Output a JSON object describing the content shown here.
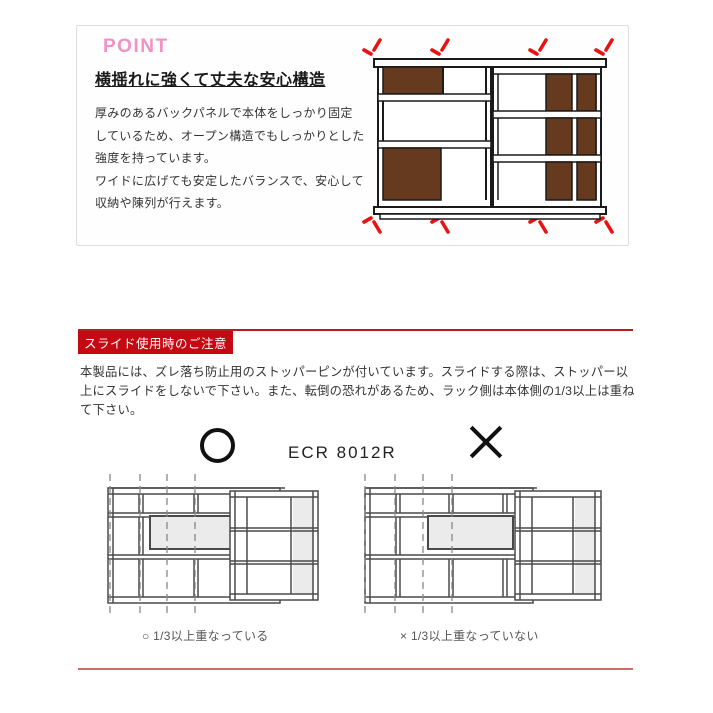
{
  "point_section": {
    "label": "POINT",
    "heading": "横揺れに強くて丈夫な安心構造",
    "body_lines": [
      "厚みのあるバックパネルで本体をしっかり固定",
      "しているため、オープン構造でもしっかりとした",
      "強度を持っています。",
      "ワイドに広げても安定したバランスで、安心して",
      "収納や陳列が行えます。"
    ]
  },
  "caution_section": {
    "title": "スライド使用時のご注意",
    "paragraph": "本製品には、ズレ落ち防止用のストッパーピンが付いています。スライドする際は、ストッパー以上にスライドをしないで下さい。また、転倒の恐れがあるため、ラック側は本体側の1/3以上は重ねて下さい。",
    "model": "ECR 8012R",
    "ok_symbol": "○",
    "ng_symbol": "×",
    "ok_caption": "○ 1/3以上重なっている",
    "ng_caption": "× 1/3以上重なっていない"
  },
  "colors": {
    "accent_pink": "#f291c5",
    "caution_red": "#c60812",
    "rule_red_top": "#b81c22",
    "rule_red_bottom": "#cf6b6b",
    "wood_brown": "#653a1f",
    "shake_mark_red": "#e81313",
    "diagram_gray": "#ebebeb"
  }
}
